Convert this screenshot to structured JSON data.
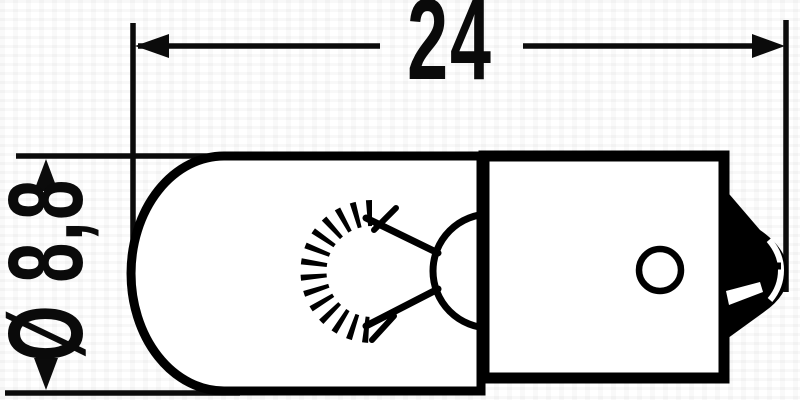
{
  "drawing": {
    "background_color": "#ffffff",
    "line_color": "#000000",
    "dimensions": {
      "length_label": "24",
      "diameter_label": "Ø 8,8"
    }
  }
}
